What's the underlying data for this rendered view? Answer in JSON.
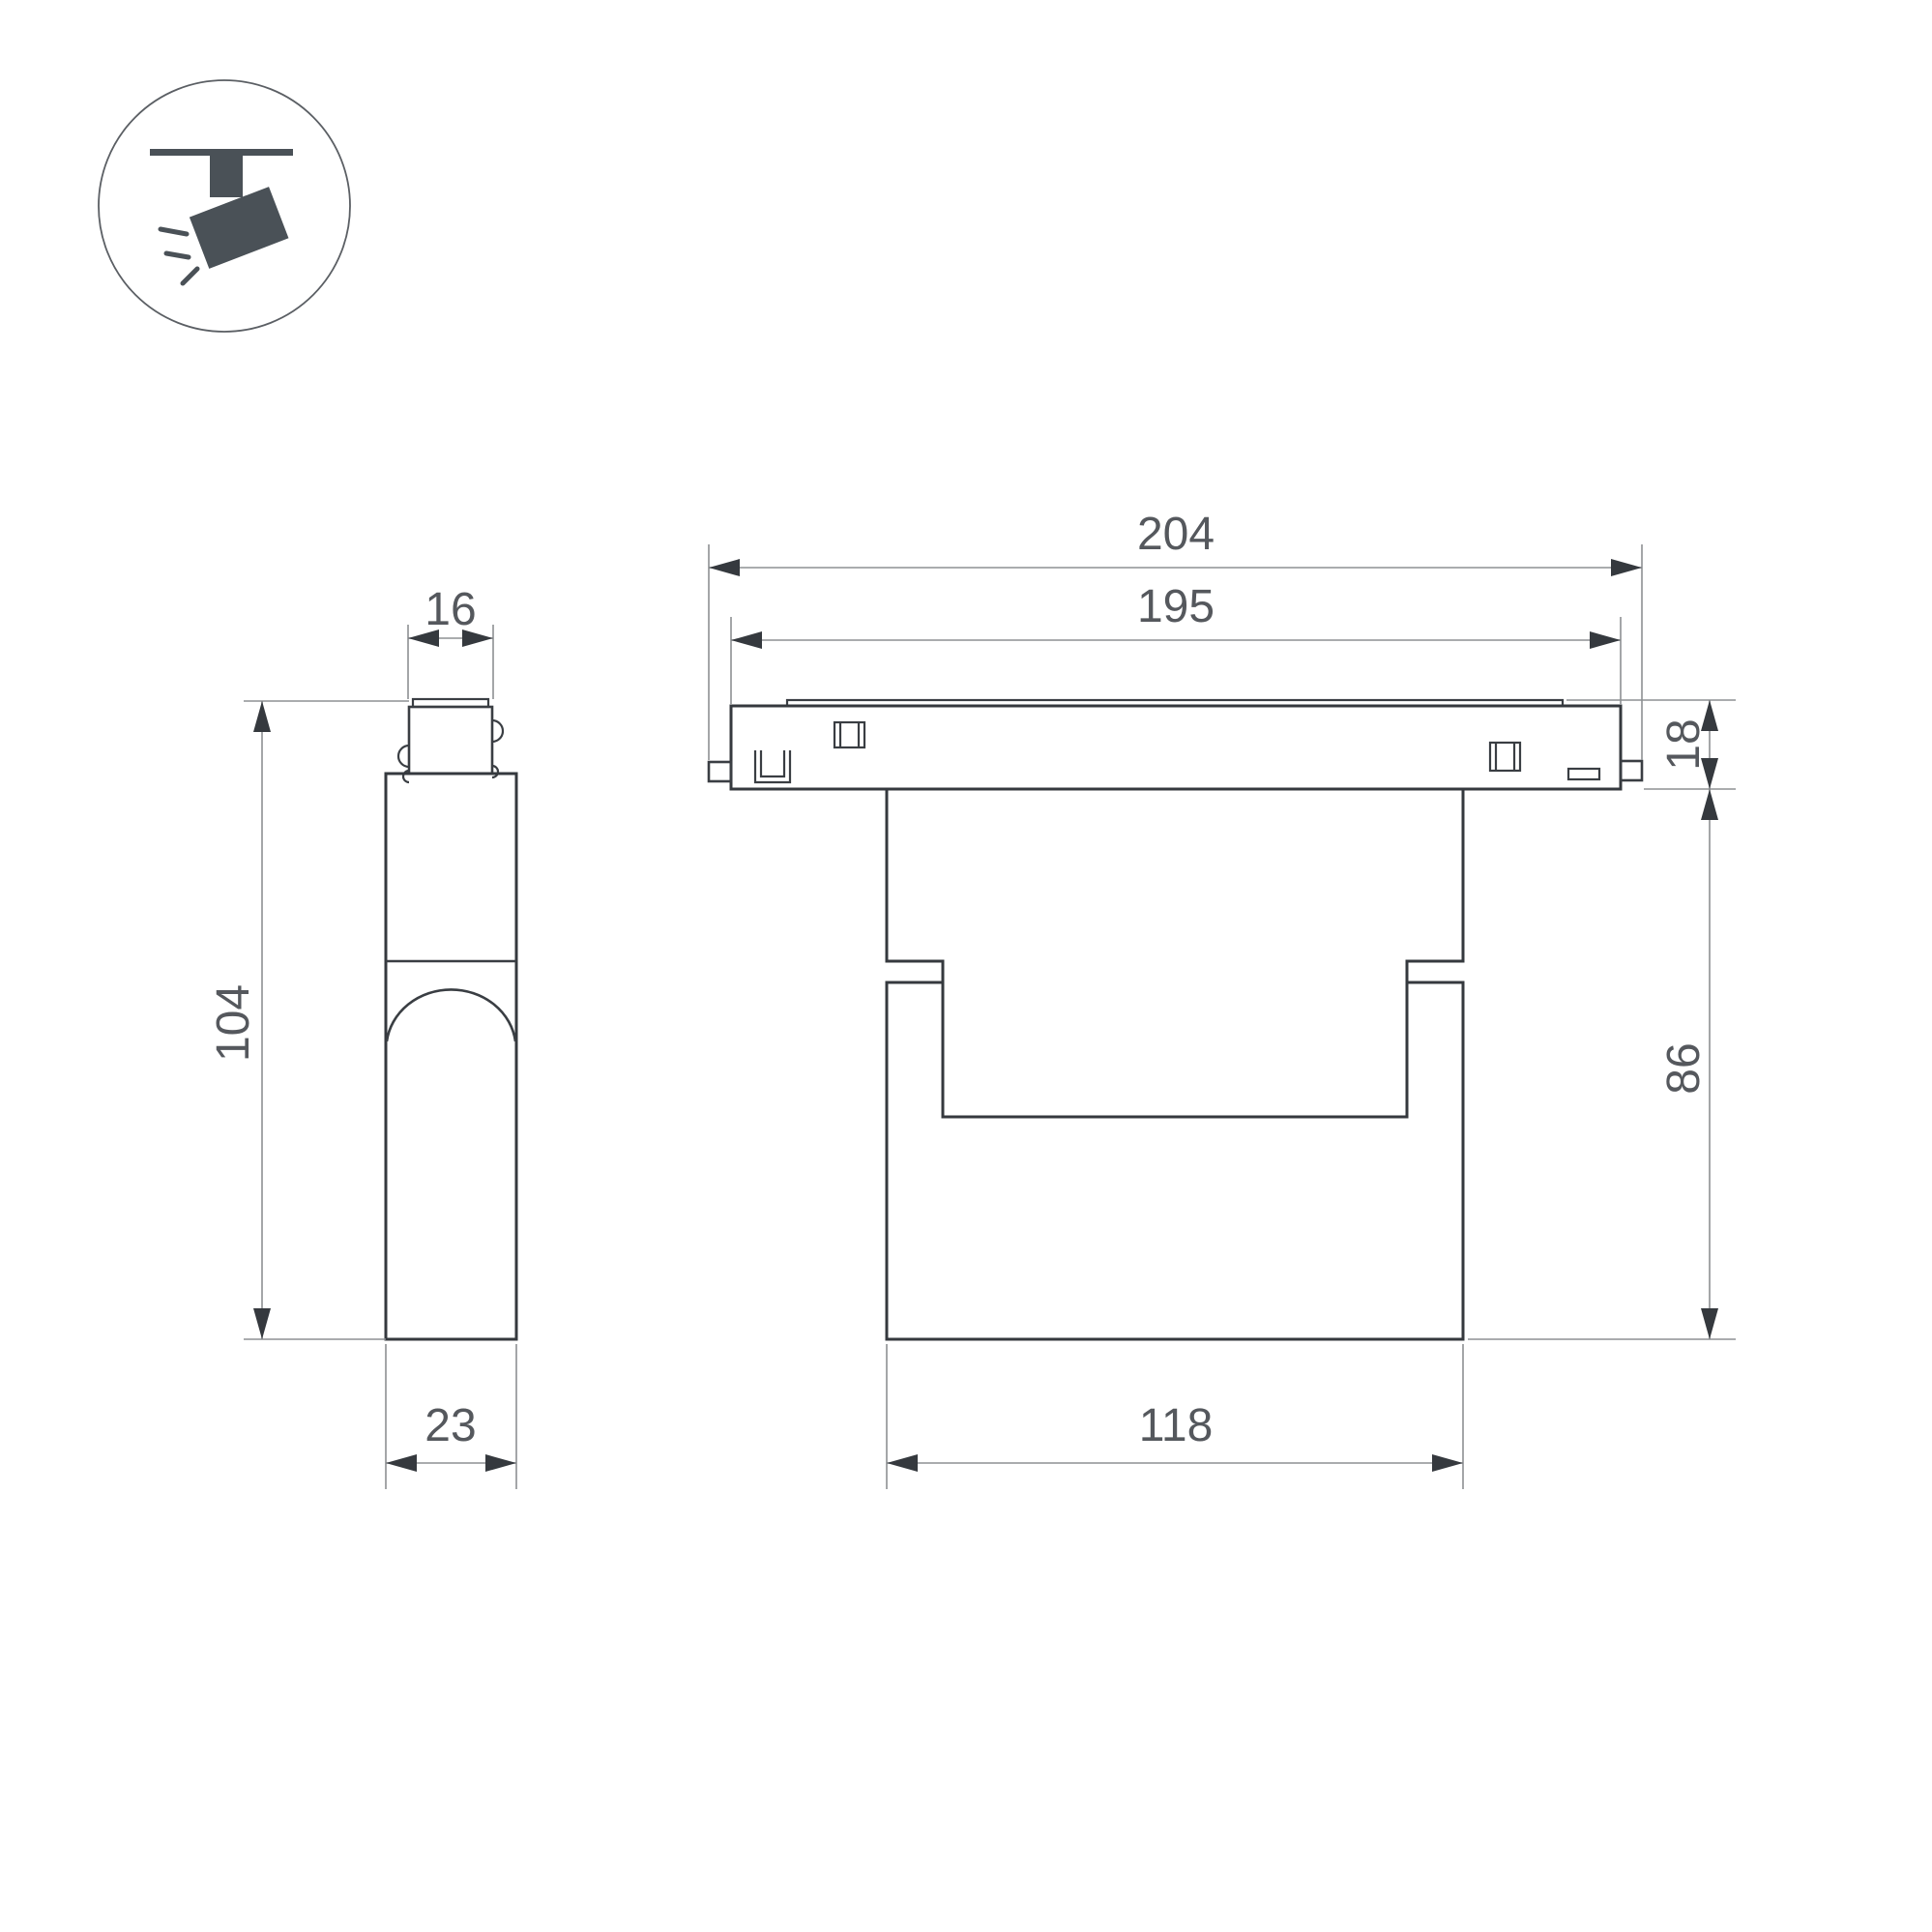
{
  "drawing": {
    "type": "technical-dimension-drawing",
    "product": "magnetic-track-spotlight",
    "icon": {
      "name": "track-spotlight-icon"
    },
    "colors": {
      "outline": "#35393e",
      "detail": "#3a3e43",
      "dimension_line": "#8d9093",
      "dimension_text": "#55585d",
      "icon": "#4a5157",
      "background": "#ffffff"
    },
    "views": {
      "side": {
        "name": "side-view",
        "dims": {
          "connector_width": "16",
          "overall_height": "104",
          "depth": "23"
        }
      },
      "front": {
        "name": "front-view",
        "dims": {
          "overall_width": "204",
          "adapter_width": "195",
          "adapter_height": "18",
          "body_height": "86",
          "body_width": "118"
        }
      }
    }
  }
}
